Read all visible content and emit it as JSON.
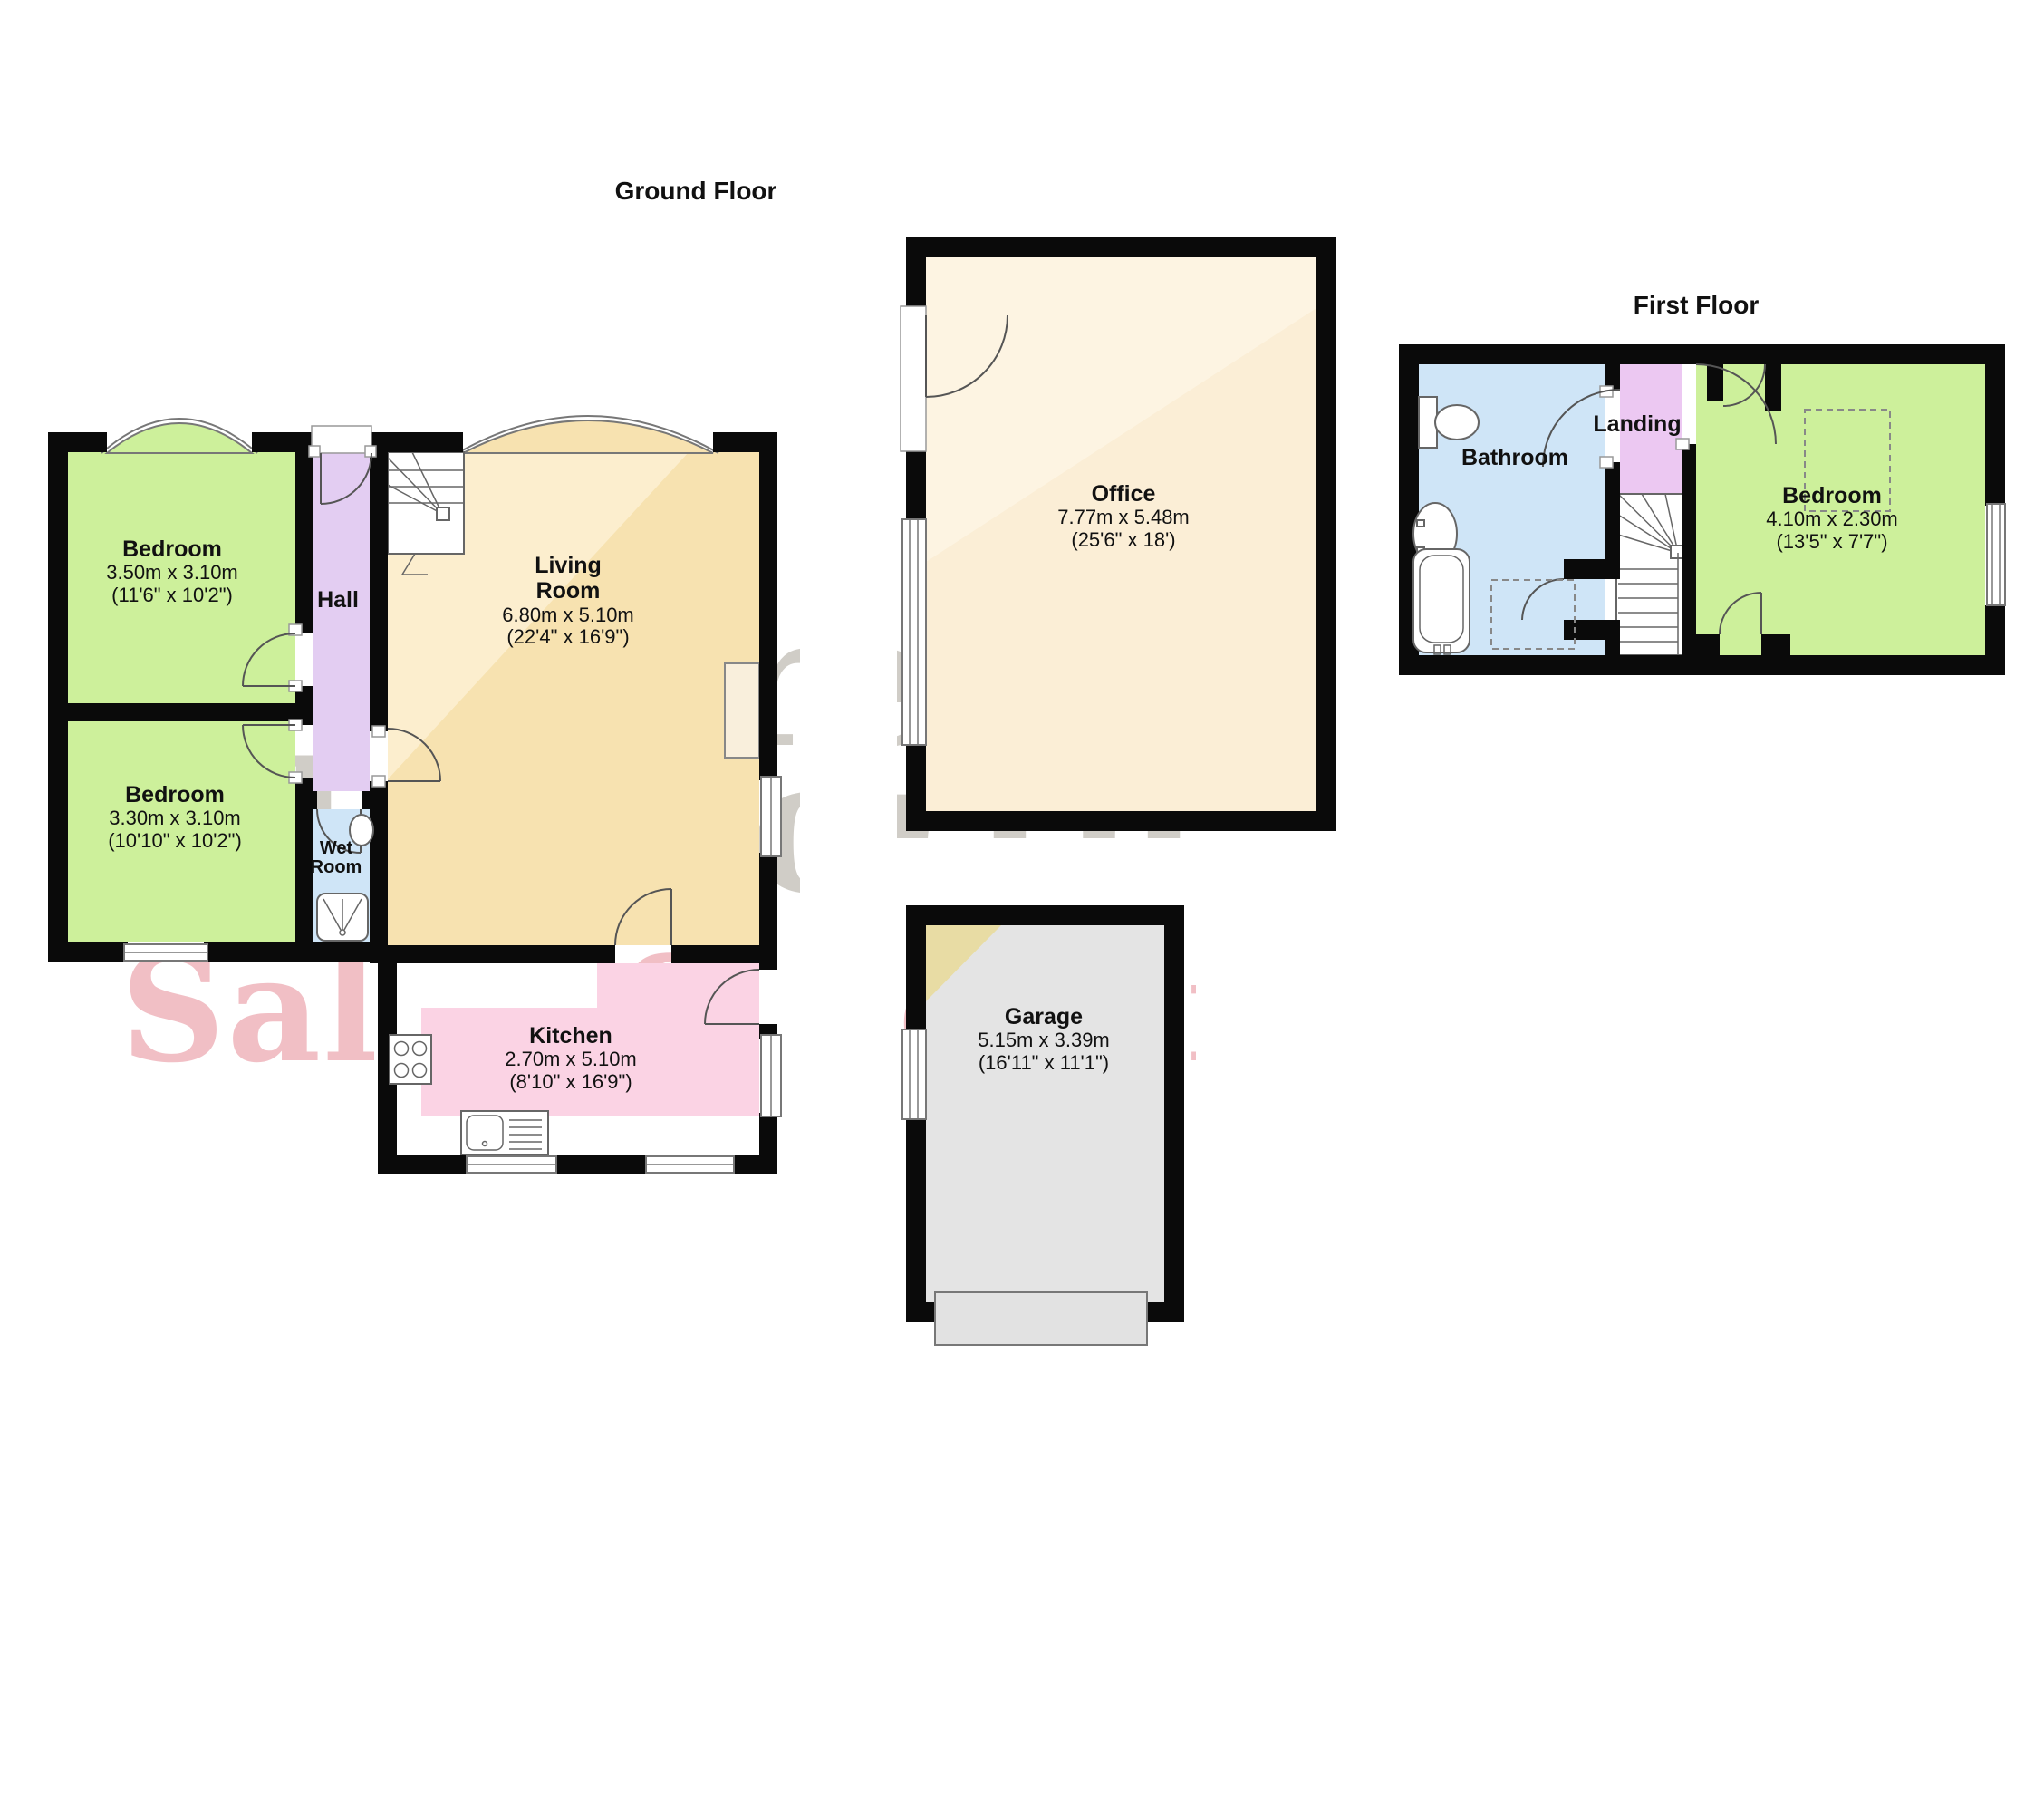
{
  "titles": {
    "ground_floor": "Ground Floor",
    "first_floor": "First Floor"
  },
  "watermark": {
    "line1": "Farrell",
    "line2": "Heyworth",
    "line3": "Sales & Lettings",
    "grey_color": "#beb5a4",
    "pink_color": "#f0a7ad"
  },
  "rooms": {
    "bedroom1": {
      "name": "Bedroom",
      "metric": "3.50m x 3.10m",
      "imperial": "(11'6\" x 10'2\")"
    },
    "bedroom2": {
      "name": "Bedroom",
      "metric": "3.30m x 3.10m",
      "imperial": "(10'10\" x 10'2\")"
    },
    "hall": {
      "name": "Hall"
    },
    "wet_room": {
      "name": "Wet\nRoom"
    },
    "living_room": {
      "name": "Living\nRoom",
      "metric": "6.80m x 5.10m",
      "imperial": "(22'4\" x 16'9\")"
    },
    "kitchen": {
      "name": "Kitchen",
      "metric": "2.70m x 5.10m",
      "imperial": "(8'10\" x 16'9\")"
    },
    "office": {
      "name": "Office",
      "metric": "7.77m x 5.48m",
      "imperial": "(25'6\" x 18')"
    },
    "garage": {
      "name": "Garage",
      "metric": "5.15m x 3.39m",
      "imperial": "(16'11\" x 11'1\")"
    },
    "bathroom": {
      "name": "Bathroom"
    },
    "landing": {
      "name": "Landing"
    },
    "bedroom3": {
      "name": "Bedroom",
      "metric": "4.10m x 2.30m",
      "imperial": "(13'5\" x 7'7\")"
    }
  },
  "colors": {
    "bedroom_green": "#cdf09b",
    "hall_purple": "#e3cdf2",
    "landing_purple": "#ecc8f2",
    "bathroom_blue": "#cfe5f7",
    "living_cream": "#f7e2b0",
    "office_cream": "#fbeed6",
    "kitchen_pink": "#fbd3e4",
    "garage_grey": "#e4e4e4",
    "wall_black": "#0a0a0a"
  }
}
